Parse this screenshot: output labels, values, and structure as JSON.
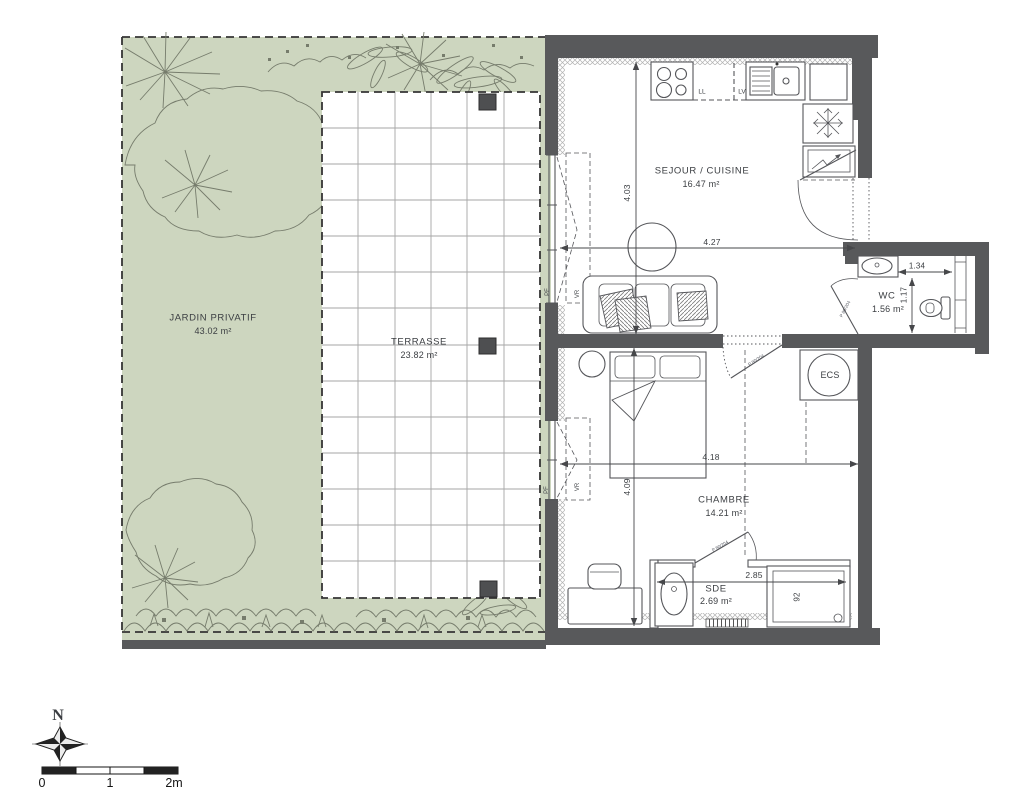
{
  "colors": {
    "wall": "#58595b",
    "garden": "#cdd6bf",
    "line": "#55565a",
    "text": "#3b3e42",
    "veg": "#767c6c"
  },
  "rooms": {
    "jardin": {
      "name": "JARDIN PRIVATIF",
      "area": "43.02 m²"
    },
    "terrasse": {
      "name": "TERRASSE",
      "area": "23.82 m²"
    },
    "sejour": {
      "name": "SEJOUR / CUISINE",
      "area": "16.47 m²"
    },
    "wc": {
      "name": "WC",
      "area": "1.56 m²"
    },
    "chambre": {
      "name": "CHAMBRE",
      "area": "14.21 m²"
    },
    "sde": {
      "name": "SDE",
      "area": "2.69 m²"
    },
    "ecs": {
      "name": "ECS"
    }
  },
  "dimensions": {
    "sejour_height": "4.03",
    "sejour_width": "4.27",
    "chambre_width": "4.18",
    "chambre_height": "4.09",
    "wc_width": "1.34",
    "wc_height": "1.17",
    "sde_width": "2.85",
    "shower_width": "92"
  },
  "appliances": {
    "washing_machine": "LL",
    "dishwasher": "LV"
  },
  "openings": {
    "french_window": "PF",
    "roller_shutter": "VR",
    "door_size": "P 80/204"
  },
  "compass": {
    "north": "N"
  },
  "scale_bar": {
    "tick_0": "0",
    "tick_1": "1",
    "tick_2": "2m"
  }
}
